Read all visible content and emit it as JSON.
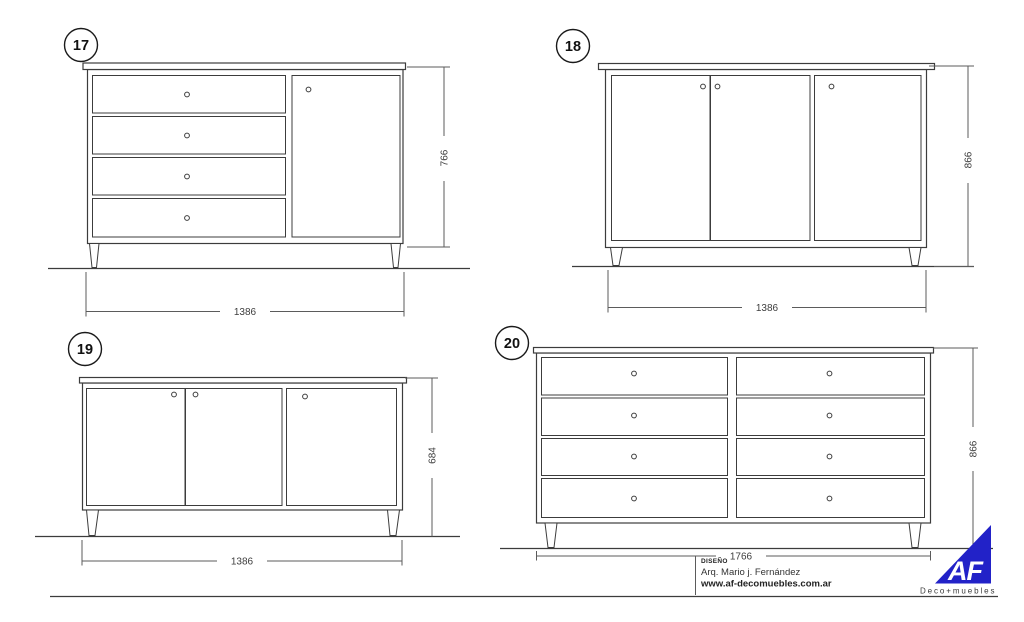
{
  "sheet": {
    "line_color": "#3c3c3c",
    "dim_color": "#5b5b5b"
  },
  "figures": [
    {
      "number": "17",
      "drawers": 4,
      "doors": 1,
      "width_label": "1386",
      "height_label": "766"
    },
    {
      "number": "18",
      "drawers": 0,
      "doors": 3,
      "width_label": "1386",
      "height_label": "866"
    },
    {
      "number": "19",
      "drawers": 0,
      "doors": 3,
      "width_label": "1386",
      "height_label": "684"
    },
    {
      "number": "20",
      "drawers": 8,
      "doors": 0,
      "width_label": "1766",
      "height_label": "866"
    }
  ],
  "title_block": {
    "design_label": "DISEÑO",
    "designer": "Arq. Mario j. Fernández",
    "website": "www.af-decomuebles.com.ar"
  },
  "logo": {
    "monogram": "AF",
    "tagline": "Deco+muebles",
    "color": "#2222c8"
  }
}
